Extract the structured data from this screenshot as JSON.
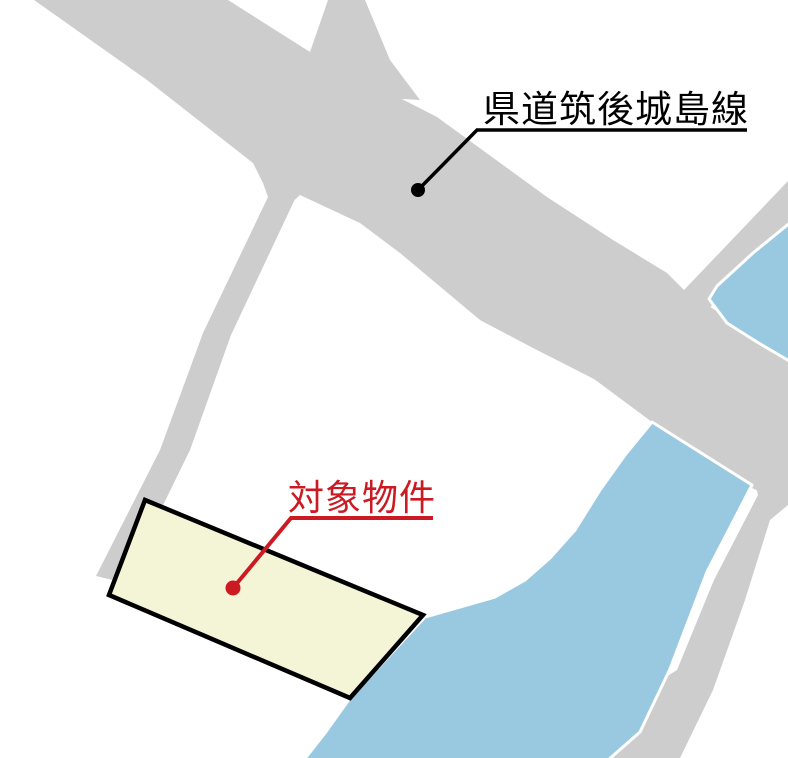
{
  "map": {
    "labels": {
      "road": {
        "text": "県道筑後城島線",
        "color": "#000000"
      },
      "parcel": {
        "text": "対象物件",
        "color": "#cc1a22"
      }
    },
    "colors": {
      "background": "#ffffff",
      "road": "#cdcdcd",
      "water": "#99c9e0",
      "water_outline": "#ffffff",
      "parcel_fill": "#f4f4d6",
      "parcel_outline": "#000000",
      "leader_black": "#000000",
      "leader_red": "#cc1a22"
    }
  }
}
